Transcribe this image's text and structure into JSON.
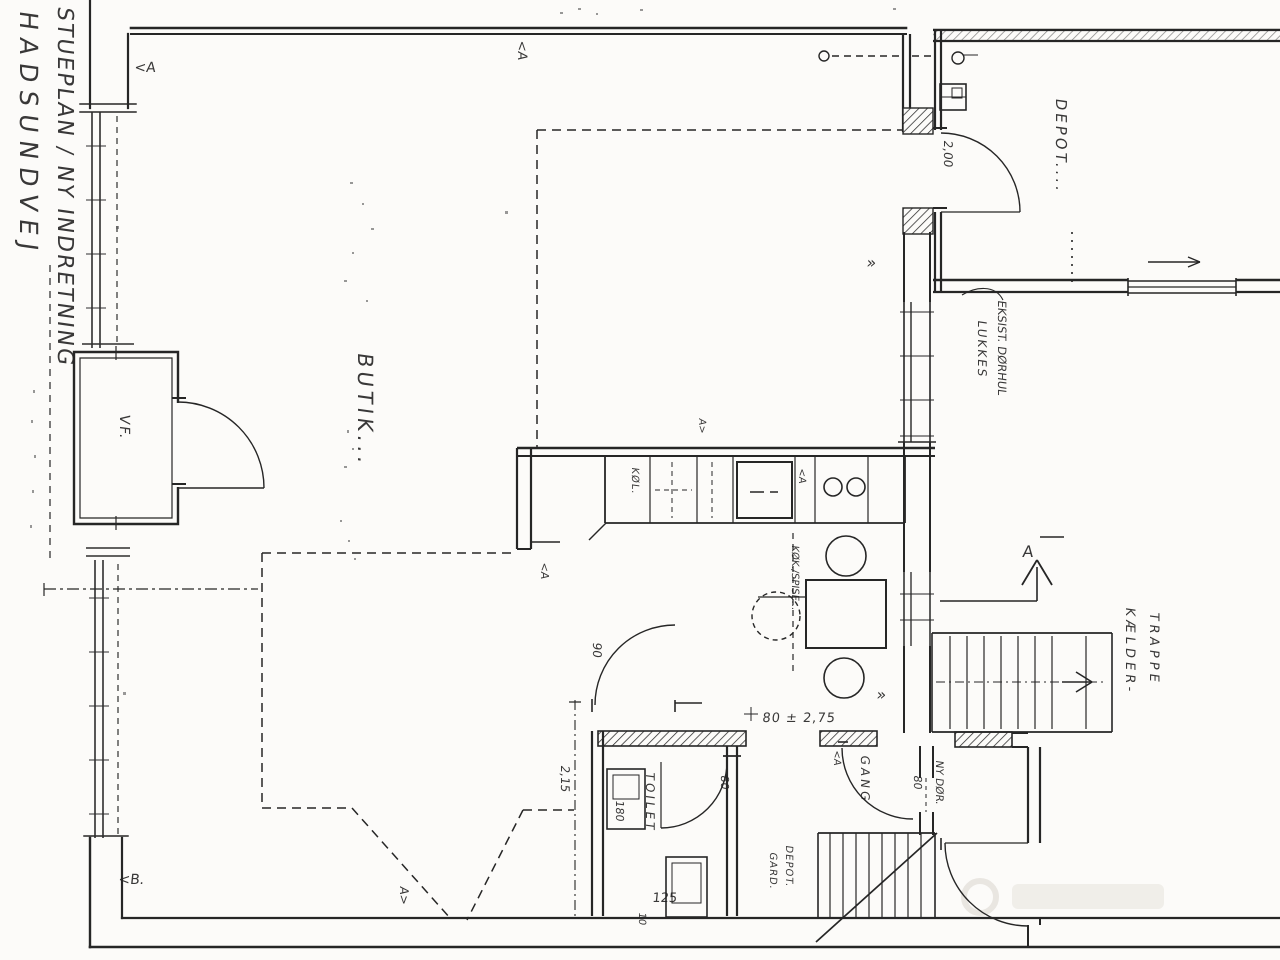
{
  "colors": {
    "ink": "#262626",
    "paper": "#fcfbf9",
    "watermark": "#edebe6"
  },
  "title": {
    "line1": "STUEPLAN / NY INDRETNING",
    "line2": "HADSUNDVEJ"
  },
  "rooms": {
    "butik": "BUTIK...",
    "vf": "VF.",
    "depot": "DEPOT....",
    "kitchen": "KØK./SPISE...",
    "fridge": "KØL.",
    "toilet": "TOILET",
    "hall": "GANG",
    "understair_line1": "DEPOT.",
    "understair_line2": "GARD.",
    "basement_line1": "KÆLDER-",
    "basement_line2": "TRAPPE"
  },
  "annotations": {
    "existing_door_line1": "EKSIST. DØRHUL",
    "existing_door_line2": "LUKKES",
    "new_door": "NY DØR.",
    "corridor_dim": "80 ± 2,75"
  },
  "dimensions": {
    "depot_door": "2,00",
    "left_wall": "2,15",
    "sink": "180",
    "wc": "125",
    "kitchen_door": "90",
    "toilet_door": "80",
    "hall_door": "80",
    "small": "10"
  },
  "markers": {
    "section_label": "A",
    "top_left": "<A",
    "bottom_left": "<B.",
    "top_center": "<A",
    "bottom_center": "A>",
    "kitchen_top": "A>",
    "kitchen_counter": "<A",
    "kitchen_door": "<A",
    "hall": "<A",
    "chevron_mid": "»",
    "chevron_low": "»"
  }
}
